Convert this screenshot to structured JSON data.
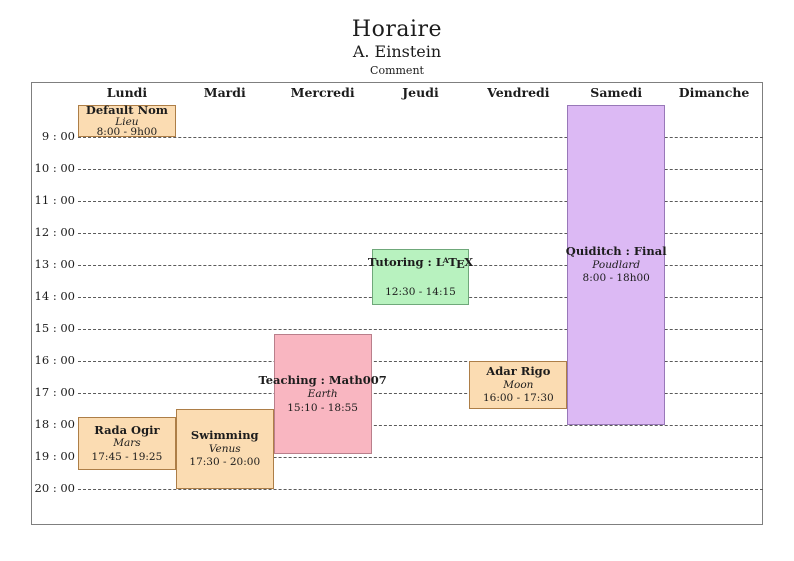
{
  "header": {
    "title": "Horaire",
    "author": "A. Einstein",
    "comment": "Comment"
  },
  "days": [
    "Lundi",
    "Mardi",
    "Mercredi",
    "Jeudi",
    "Vendredi",
    "Samedi",
    "Dimanche"
  ],
  "time_axis": {
    "labels": [
      "9 : 00",
      "10 : 00",
      "11 : 00",
      "12 : 00",
      "13 : 00",
      "14 : 00",
      "15 : 00",
      "16 : 00",
      "17 : 00",
      "18 : 00",
      "19 : 00",
      "20 : 00"
    ],
    "start_hour": 9,
    "end_hour": 20
  },
  "palette": {
    "orange": {
      "fill": "#FBDCB2",
      "border": "#AD7E47"
    },
    "pink": {
      "fill": "#F9B6C1",
      "border": "#B97F8B"
    },
    "green": {
      "fill": "#B8F2BF",
      "border": "#6FA87A"
    },
    "purple": {
      "fill": "#DCB9F4",
      "border": "#9878B8"
    }
  },
  "frame_colors": {
    "border": "#7f7f7f",
    "gridline": "#5a5a5a",
    "text": "#1c1c1c"
  },
  "events": [
    {
      "title": "Default Nom",
      "location": "Lieu",
      "time": "8:00 - 9h00",
      "day": "Lundi",
      "day_index": 0,
      "start": 8.0,
      "end": 9.0,
      "color": "orange",
      "latex_logo": false
    },
    {
      "title": "Rada Ogir",
      "location": "Mars",
      "time": "17:45 - 19:25",
      "day": "Lundi",
      "day_index": 0,
      "start": 17.75,
      "end": 19.4167,
      "color": "orange",
      "latex_logo": false
    },
    {
      "title": "Swimming",
      "location": "Venus",
      "time": "17:30 - 20:00",
      "day": "Mardi",
      "day_index": 1,
      "start": 17.5,
      "end": 20.0,
      "color": "orange",
      "latex_logo": false
    },
    {
      "title": "Teaching : Math007",
      "location": "Earth",
      "time": "15:10 - 18:55",
      "day": "Mercredi",
      "day_index": 2,
      "start": 15.1667,
      "end": 18.9167,
      "color": "pink",
      "latex_logo": false
    },
    {
      "title": "Tutoring : LaTeX",
      "location": "",
      "time": "12:30 - 14:15",
      "day": "Jeudi",
      "day_index": 3,
      "start": 12.5,
      "end": 14.25,
      "color": "green",
      "latex_logo": true
    },
    {
      "title": "Adar Rigo",
      "location": "Moon",
      "time": "16:00 - 17:30",
      "day": "Vendredi",
      "day_index": 4,
      "start": 16.0,
      "end": 17.5,
      "color": "orange",
      "latex_logo": false
    },
    {
      "title": "Quiditch : Final",
      "location": "Poudlard",
      "time": "8:00 - 18h00",
      "day": "Samedi",
      "day_index": 5,
      "start": 8.0,
      "end": 18.0,
      "color": "purple",
      "latex_logo": false
    }
  ]
}
